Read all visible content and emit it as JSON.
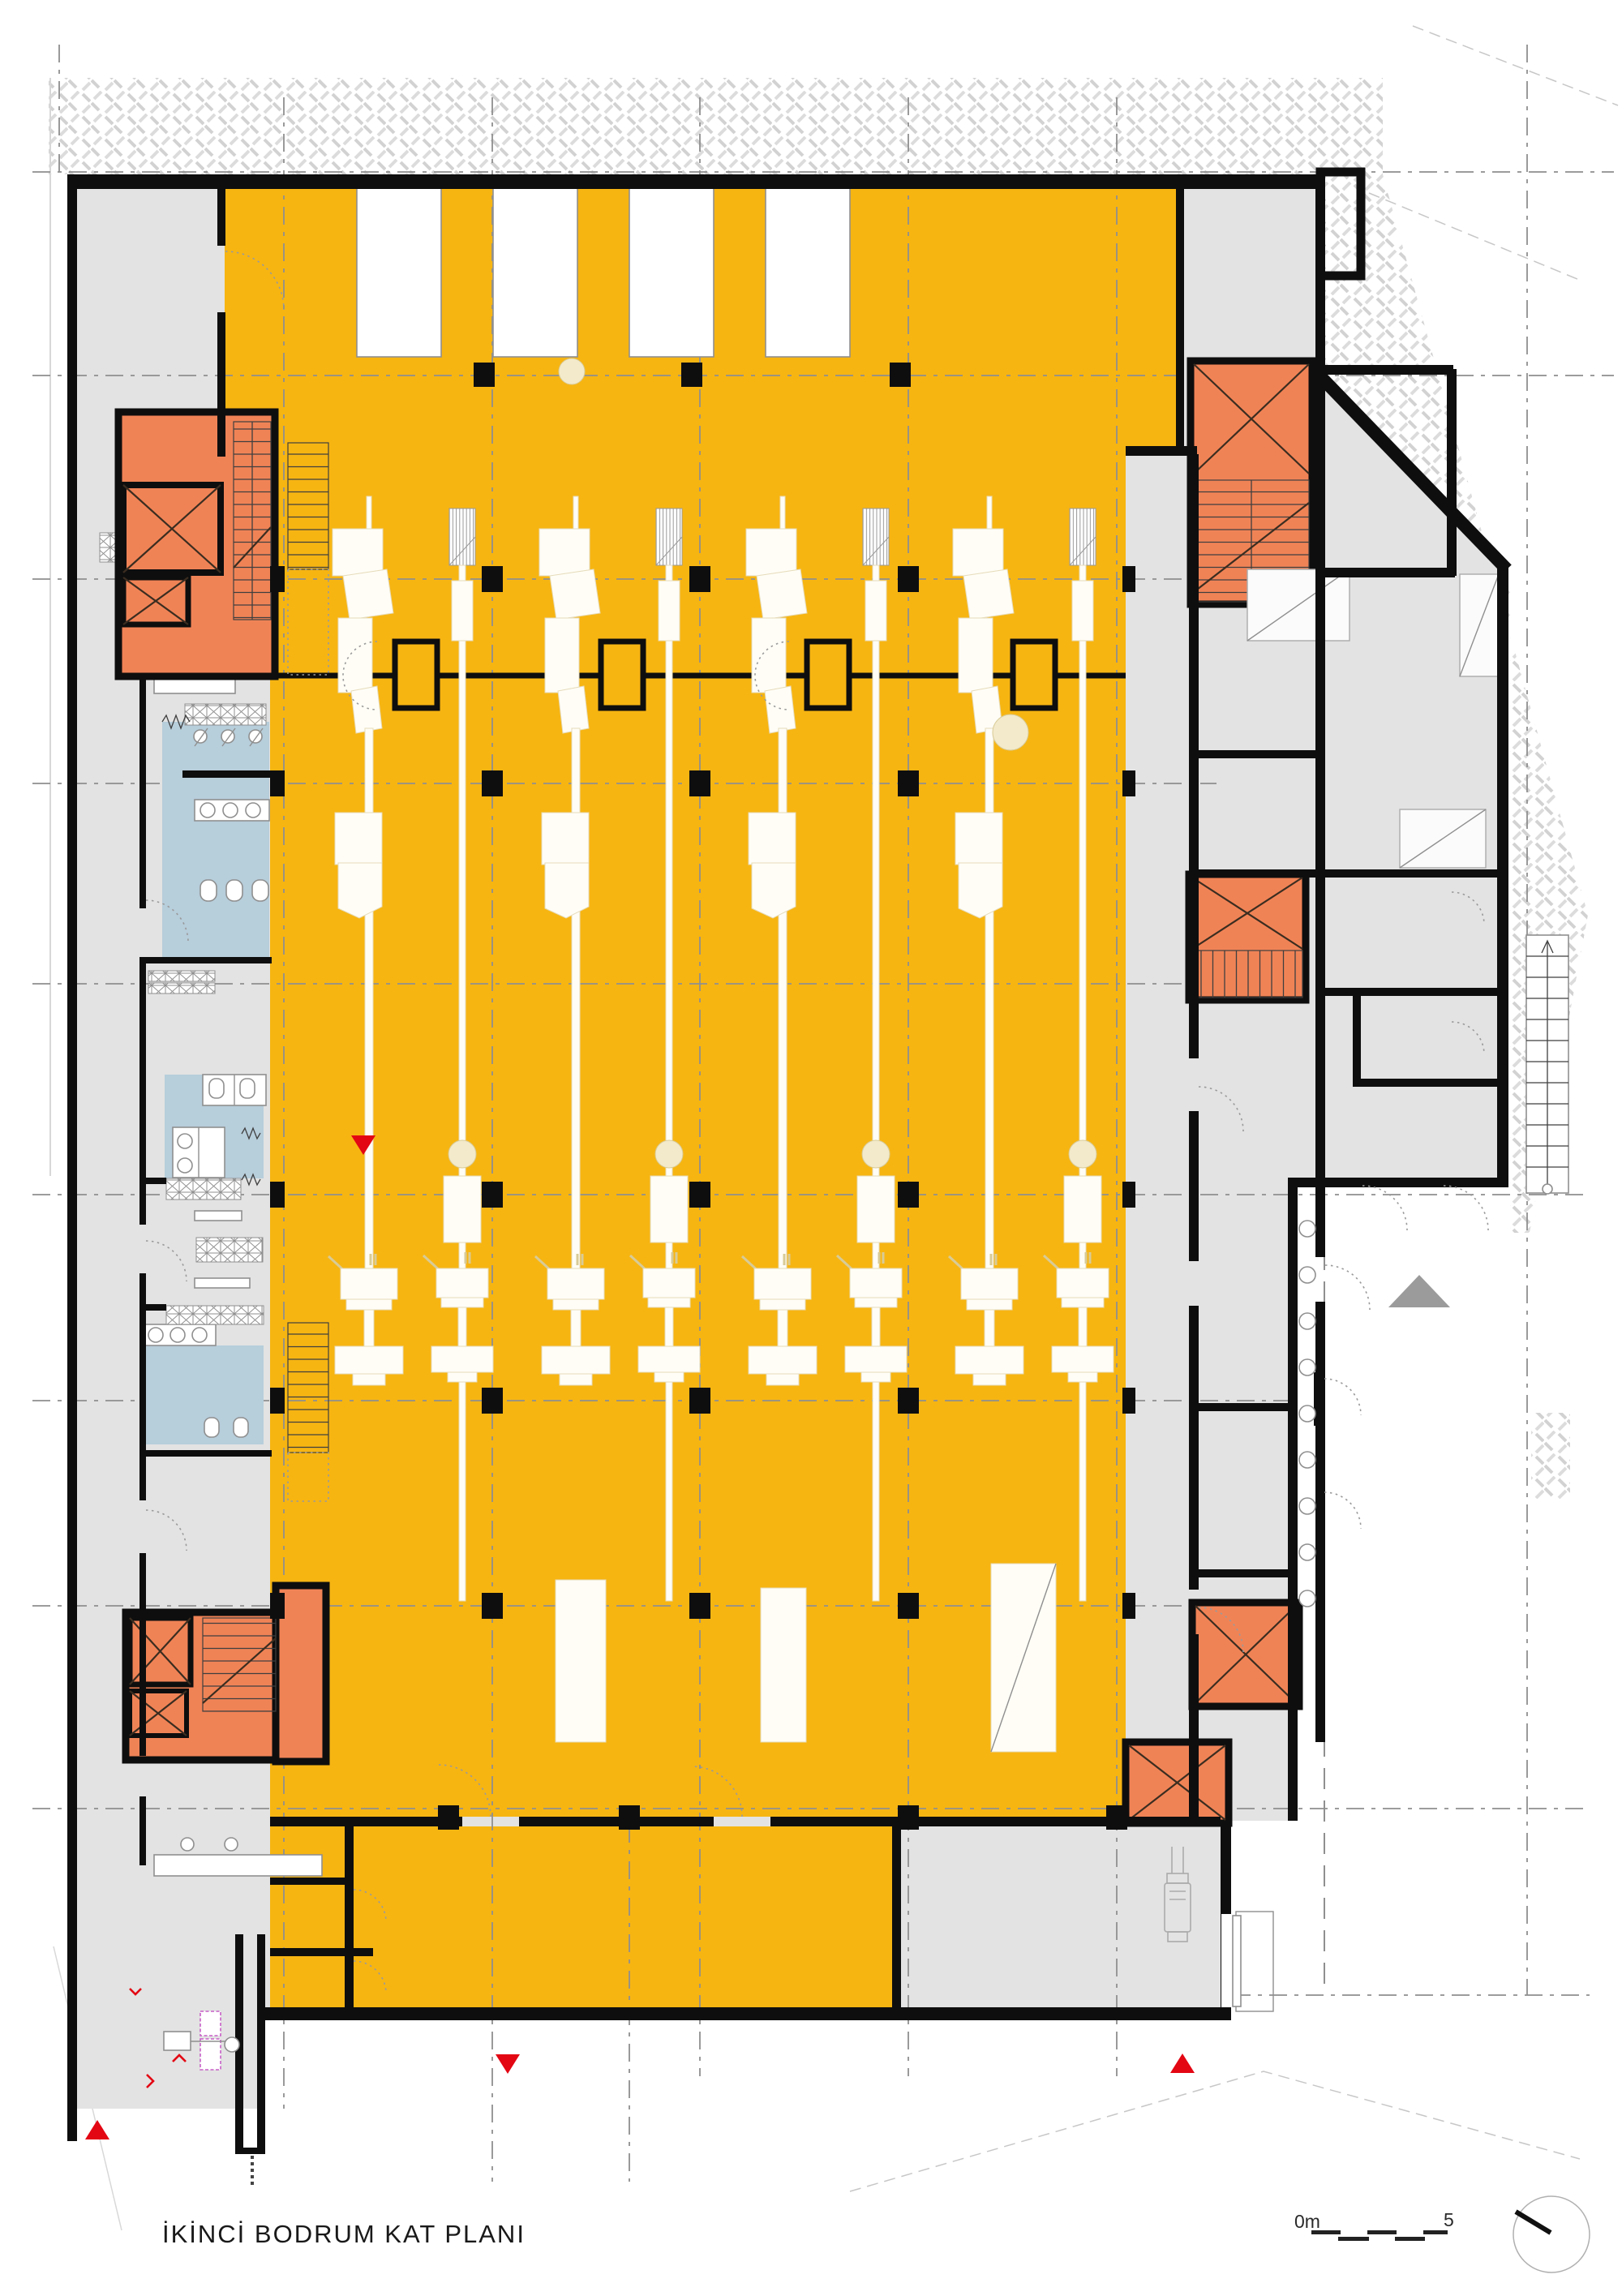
{
  "sheet": {
    "title": "İKİNCİ BODRUM KAT PLANI"
  },
  "scale_bar": {
    "start": "0m",
    "end": "5"
  },
  "colors": {
    "hall_yellow": "#F7B512",
    "machine_beige": "#F3EACB",
    "core_orange": "#F08356",
    "wet_blue": "#B7CEDB",
    "floor_gray": "#E3E3E3",
    "wall_black": "#0E0E0E",
    "marker_red": "#E30613",
    "ramp_gray": "#9B9B9B",
    "hatch_gray": "#D7D7D7",
    "grid_gray": "#8F8F8F",
    "fixture_magenta": "#C75FC7"
  },
  "markers": {
    "red_triangle_left": "section-marker-down",
    "red_triangle_bottom_center": "section-marker-down",
    "red_triangle_bottom_right": "section-marker-up",
    "red_triangle_bottom_left": "section-marker-up",
    "gray_triangle_courtyard": "ramp-direction-up",
    "north_arrow": "north-needle-circle"
  }
}
